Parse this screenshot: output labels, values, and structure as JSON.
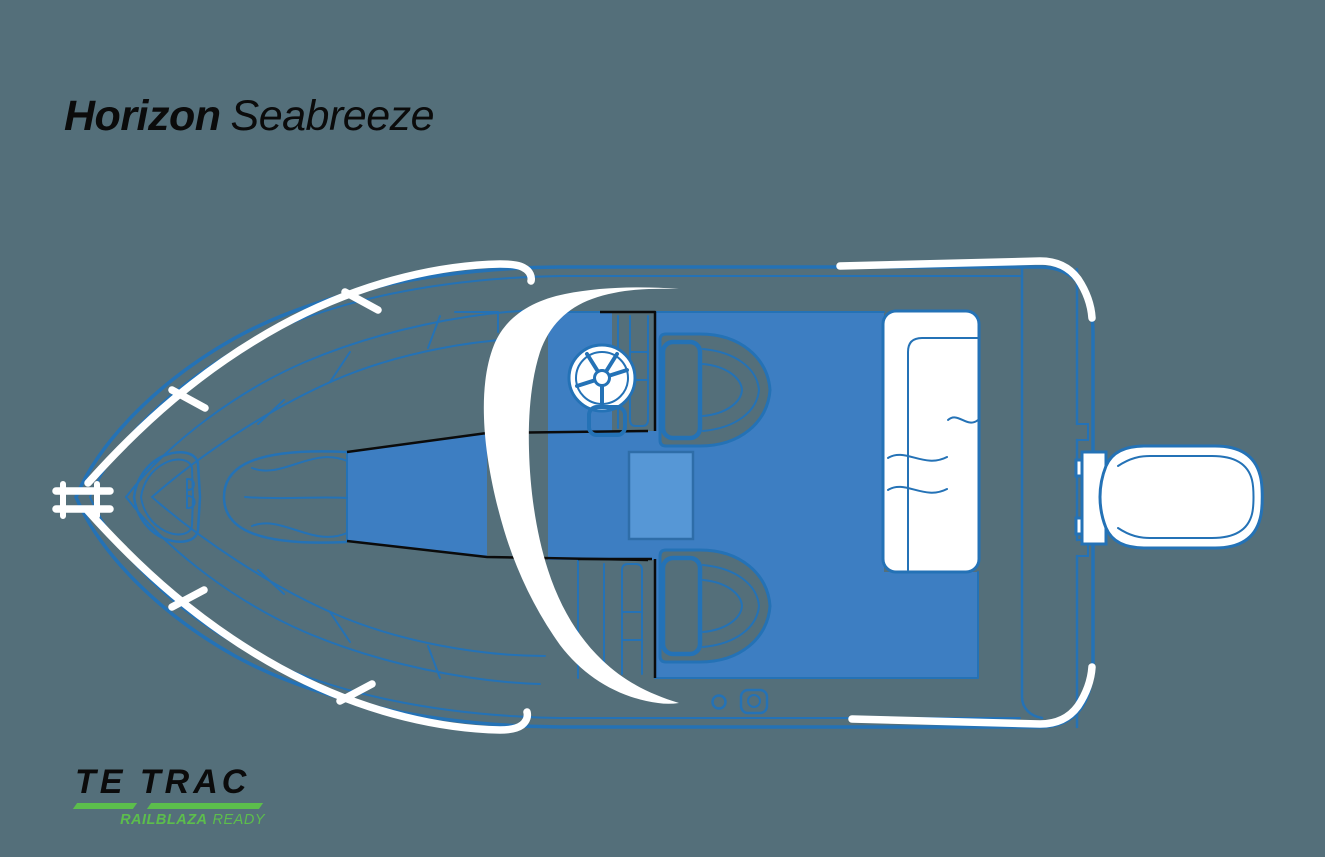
{
  "header": {
    "title_primary": "Horizon",
    "title_secondary": "Seabreeze"
  },
  "footer": {
    "brand": "TE TRAC",
    "tagline_strong": "RAILBLAZA",
    "tagline_rest": "READY"
  },
  "theme": {
    "background": "#546F7A",
    "outline_blue": "#2472B6",
    "deck_blue": "#3D7EC2",
    "hatch_blue": "#5697D6",
    "accent_green": "#5CBE4C",
    "ink_black": "#0B0B0B",
    "white": "#FFFFFF"
  },
  "diagram": {
    "type": "boat-top-view-deck-plan",
    "subject": "Horizon Seabreeze",
    "parts": [
      "hull-outline",
      "bow-cleat",
      "bow-rail-top",
      "bow-rail-bottom",
      "anchor-locker",
      "foredeck-panels",
      "bow-seating-contours",
      "walkthrough-passage",
      "windscreen",
      "helm-console",
      "steering-wheel",
      "throttle-box",
      "companion-steps",
      "cockpit-floor",
      "floor-hatch",
      "pedestal-seat-port",
      "pedestal-seat-starboard",
      "stern-bench",
      "transom",
      "stern-rail-top",
      "stern-rail-bottom",
      "drain-port",
      "railblaza-starport-mount",
      "outboard-motor"
    ]
  }
}
